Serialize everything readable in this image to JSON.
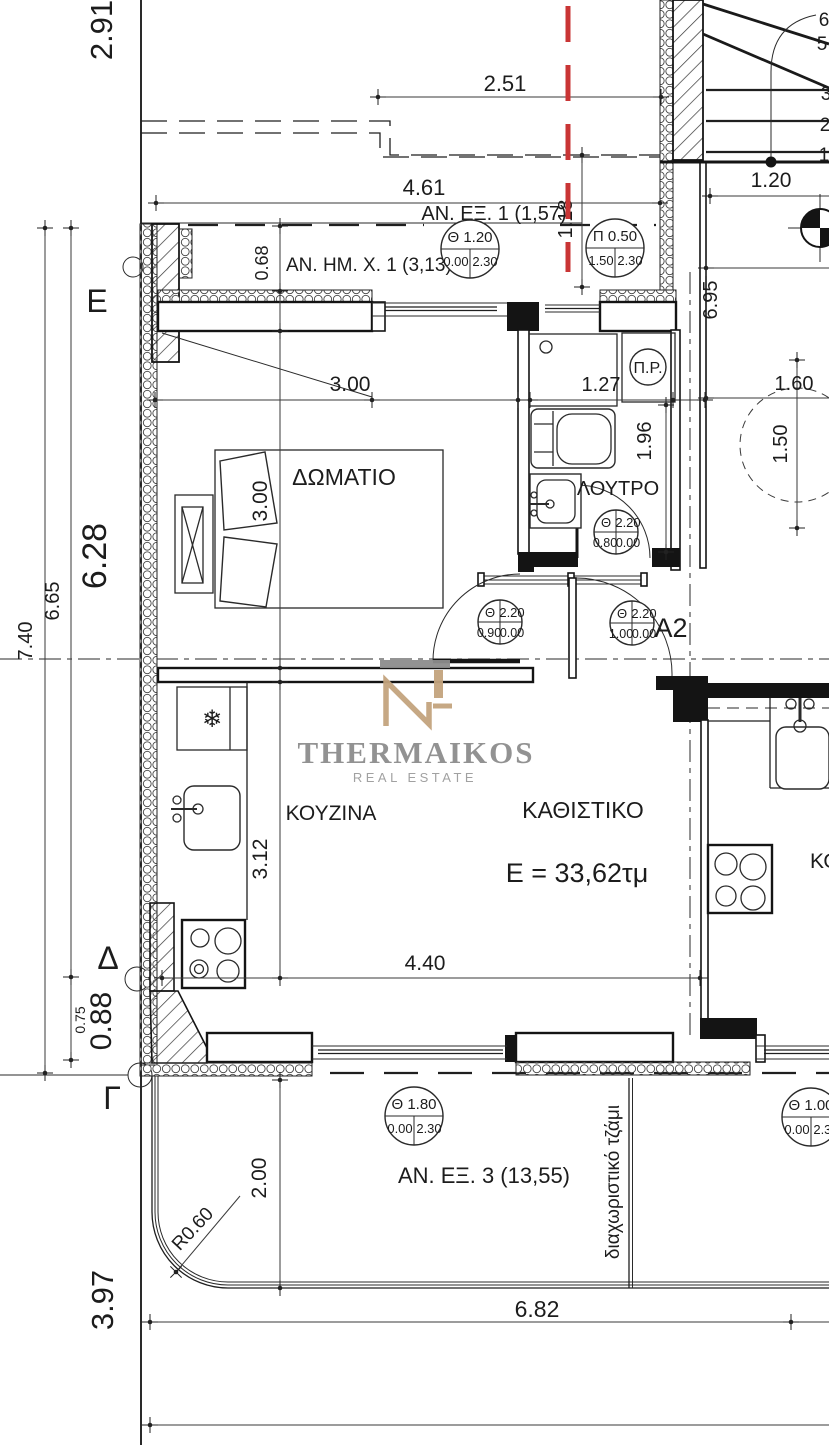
{
  "brand": {
    "name": "THERMAIKOS",
    "tagline": "REAL ESTATE"
  },
  "apartment": {
    "id": "Α2",
    "area_label": "Ε = 33,62τμ"
  },
  "rooms": {
    "bedroom": "ΔΩΜΑΤΙΟ",
    "bathroom": "ΛΟΥΤΡΟ",
    "kitchen": "ΚΟΥΖΙΝΑ",
    "living": "ΚΑΘΙΣΤΙΚΟ",
    "water_heater": "Π.Ρ.",
    "neighbor_kitchen": "ΚΟΥΖΙΝΑ"
  },
  "balconies": {
    "front": "ΑΝ. ΕΞ. 1 (1,57)",
    "side": "ΑΝ. ΗΜ. Χ. 1 (3,13)",
    "rear": "ΑΝ. ΕΞ. 3 (13,55)",
    "divider_note": "διαχωριστικό τζάμι"
  },
  "grid": {
    "e": "Ε",
    "d": "Δ",
    "g": "Γ"
  },
  "stairs": {
    "n1": "1",
    "n2": "2",
    "n3": "3",
    "n5": "5",
    "n6": "6"
  },
  "icons": {
    "fridge": "❄"
  },
  "dims": {
    "d291": "2.91",
    "d251": "2.51",
    "d461": "4.61",
    "d118": "1.18",
    "d120": "1.20",
    "d068": "0.68",
    "d695": "6.95",
    "d300_closet": "3.00",
    "d127": "1.27",
    "d196": "1.96",
    "d160": "1.60",
    "d150": "1.50",
    "d300_bed": "3.00",
    "d628": "6.28",
    "d665": "6.65",
    "d740": "7.40",
    "d312": "3.12",
    "d440": "4.40",
    "d088": "0.88",
    "d075": "0.75",
    "d200": "2.00",
    "r060": "R0.60",
    "d682": "6.82",
    "d397": "3.97"
  },
  "bubbles": [
    {
      "t1": "Θ 1.20",
      "t2": "",
      "bl": "0.00",
      "br": "2.30"
    },
    {
      "t1": "Π 0.50",
      "t2": "",
      "bl": "1.50",
      "br": "2.30"
    },
    {
      "t1": "Θ",
      "t2": "2.20",
      "bl": "0.80",
      "br": "0.00"
    },
    {
      "t1": "Θ",
      "t2": "2.20",
      "bl": "0.90",
      "br": "0.00"
    },
    {
      "t1": "Θ",
      "t2": "2.20",
      "bl": "1.00",
      "br": "0.00"
    },
    {
      "t1": "Θ 1.80",
      "t2": "",
      "bl": "0.00",
      "br": "2.30"
    },
    {
      "t1": "Θ 1.00",
      "t2": "",
      "bl": "0.00",
      "br": "2.30"
    }
  ],
  "colors": {
    "line": "#1f1f1f",
    "section_cut": "#c93535",
    "logo_gold": "#c3a47e",
    "logo_gray": "#8d8d8d"
  }
}
